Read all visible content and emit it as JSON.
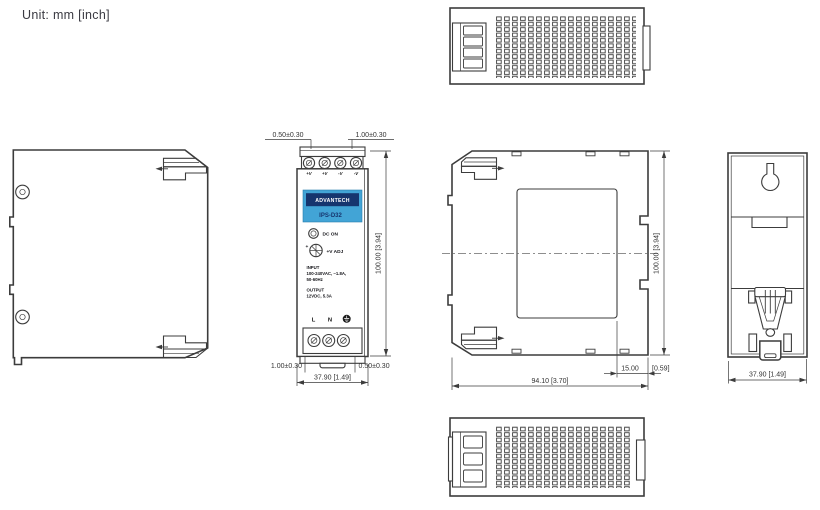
{
  "unit_label": "Unit: mm  [inch]",
  "colors": {
    "line": "#3c3c3c",
    "brand_navy": "#16356e",
    "brand_blue": "#42a4d6",
    "label_text": "#ffffff"
  },
  "front_panel": {
    "brand": "ADVANTECH",
    "model": "IPS-D32",
    "led_label": "DC ON",
    "adj_plus": "+",
    "adj_label": "+V ADJ",
    "input_title": "INPUT",
    "input_line1": "100-240VAC, ~1.8A,",
    "input_line2": "50-60Hz",
    "output_title": "OUTPUT",
    "output_line1": "12VDC, 5.3A",
    "top_terminals": [
      "+V",
      "+V",
      "-V",
      "-V"
    ],
    "bottom_terminal_l": "L",
    "bottom_terminal_n": "N"
  },
  "icons": {
    "ground_terminal": "earth-ground-symbol",
    "led_indicator": "round-led",
    "potentiometer": "adjust-screw",
    "keyhole": "keyhole-mount",
    "din_clip": "din-rail-clip"
  },
  "dimensions": {
    "front_top_left": "0.50±0.30",
    "front_top_right": "1.00±0.30",
    "front_height": "100.00 [3.94]",
    "front_bottom_left": "1.00±0.30",
    "front_bottom_right": "0.50±0.30",
    "front_width": "37.90 [1.49]",
    "side_height": "100.00 [3.94]",
    "side_width": "94.10 [3.70]",
    "side_clip_mm": "15.00",
    "side_clip_inch": "[0.59]",
    "back_width": "37.90 [1.49]"
  }
}
